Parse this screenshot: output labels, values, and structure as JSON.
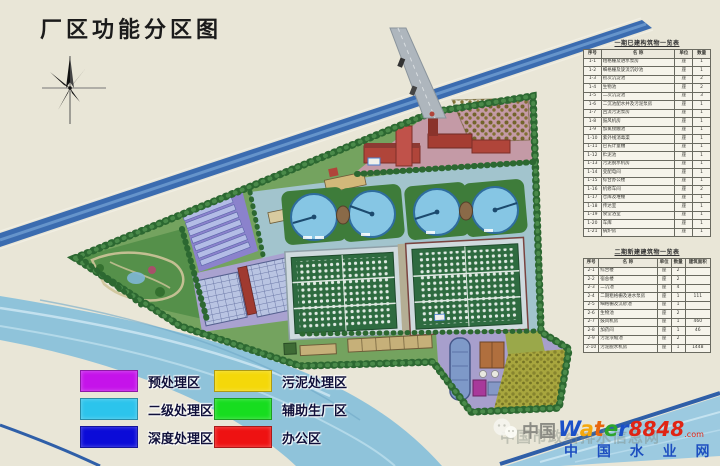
{
  "title": "厂区功能分区图",
  "legend": {
    "items": [
      {
        "label": "预处理区",
        "color": "#c513ea"
      },
      {
        "label": "污泥处理区",
        "color": "#f4d80a"
      },
      {
        "label": "二级处理区",
        "color": "#2cc4ec"
      },
      {
        "label": "辅助生厂区",
        "color": "#17dd1f"
      },
      {
        "label": "深度处理区",
        "color": "#0b0bd8"
      },
      {
        "label": "办公区",
        "color": "#ee1212"
      }
    ]
  },
  "tables": [
    {
      "title": "一期已建构筑物一览表",
      "headers": [
        "序号",
        "名  称",
        "单位",
        "数量"
      ],
      "rows": [
        [
          "1-1",
          "粗格栅及进水泵房",
          "座",
          "1"
        ],
        [
          "1-2",
          "细格栅及旋流沉砂池",
          "座",
          "1"
        ],
        [
          "1-3",
          "初次沉淀池",
          "座",
          "2"
        ],
        [
          "1-4",
          "生物池",
          "座",
          "2"
        ],
        [
          "1-5",
          "二次沉淀池",
          "座",
          "3"
        ],
        [
          "1-6",
          "二沉池配水井及污泥泵房",
          "座",
          "1"
        ],
        [
          "1-7",
          "回流污泥泵房",
          "座",
          "1"
        ],
        [
          "1-8",
          "鼓风机房",
          "座",
          "1"
        ],
        [
          "1-9",
          "加氯接触池",
          "座",
          "1"
        ],
        [
          "1-10",
          "紫外线消毒渠",
          "座",
          "1"
        ],
        [
          "1-11",
          "巴氏计量槽",
          "座",
          "1"
        ],
        [
          "1-12",
          "贮泥池",
          "座",
          "1"
        ],
        [
          "1-13",
          "污泥脱水机房",
          "座",
          "1"
        ],
        [
          "1-14",
          "变配电间",
          "座",
          "1"
        ],
        [
          "1-15",
          "综合办公楼",
          "座",
          "1"
        ],
        [
          "1-16",
          "机修车间",
          "座",
          "2"
        ],
        [
          "1-17",
          "仓库及堆棚",
          "座",
          "1"
        ],
        [
          "1-18",
          "传达室",
          "座",
          "1"
        ],
        [
          "1-19",
          "食堂浴室",
          "座",
          "1"
        ],
        [
          "1-20",
          "车库",
          "座",
          "1"
        ],
        [
          "1-21",
          "锅炉房",
          "座",
          "1"
        ]
      ]
    },
    {
      "title": "二期新建建筑物一览表",
      "headers": [
        "序号",
        "名  称",
        "单位",
        "数量",
        "建筑面积"
      ],
      "rows": [
        [
          "2-1",
          "综合楼",
          "座",
          "2",
          ""
        ],
        [
          "2-2",
          "宿舍楼",
          "座",
          "2",
          ""
        ],
        [
          "2-3",
          "二沉池",
          "座",
          "4",
          ""
        ],
        [
          "2-4",
          "二期粗格栅及进水泵房",
          "座",
          "1",
          "111"
        ],
        [
          "2-5",
          "细格栅及沉砂池",
          "座",
          "1",
          ""
        ],
        [
          "2-6",
          "生物池",
          "座",
          "2",
          ""
        ],
        [
          "2-7",
          "鼓风机房",
          "座",
          "1",
          "460"
        ],
        [
          "2-8",
          "加药间",
          "座",
          "1",
          "46"
        ],
        [
          "2-9",
          "污泥浓缩池",
          "座",
          "2",
          ""
        ],
        [
          "2-10",
          "污泥脱水机房",
          "座",
          "1",
          "1448"
        ]
      ]
    }
  ],
  "map": {
    "zones": [
      {
        "name": "site-green",
        "color": "#74a35f"
      },
      {
        "name": "park",
        "color": "#55904a"
      },
      {
        "name": "secondary",
        "color": "#a2c4cd"
      },
      {
        "name": "office",
        "color": "#c49aa6"
      },
      {
        "name": "pretreatment",
        "color": "#8b82cc"
      },
      {
        "name": "advanced",
        "color": "#a9a2d0"
      },
      {
        "name": "sludge",
        "color": "#a79fcc"
      },
      {
        "name": "forest",
        "color": "#a8a63e"
      }
    ],
    "rivers": {
      "upper": "#3b6cb0",
      "lower": "#8fc3da"
    }
  },
  "watermark": {
    "ghost_text": "中国市政给排水信息网",
    "prefix": "中国",
    "brand_letters": [
      {
        "ch": "W",
        "color": "#1b50c8"
      },
      {
        "ch": "a",
        "color": "#f4a70c"
      },
      {
        "ch": "t",
        "color": "#e8650e"
      },
      {
        "ch": "e",
        "color": "#2ca52c"
      },
      {
        "ch": "r",
        "color": "#1b50c8"
      }
    ],
    "brand_num": "8848",
    "brand_dotcom": ".com",
    "site_name": "中 国 水 业 网"
  }
}
